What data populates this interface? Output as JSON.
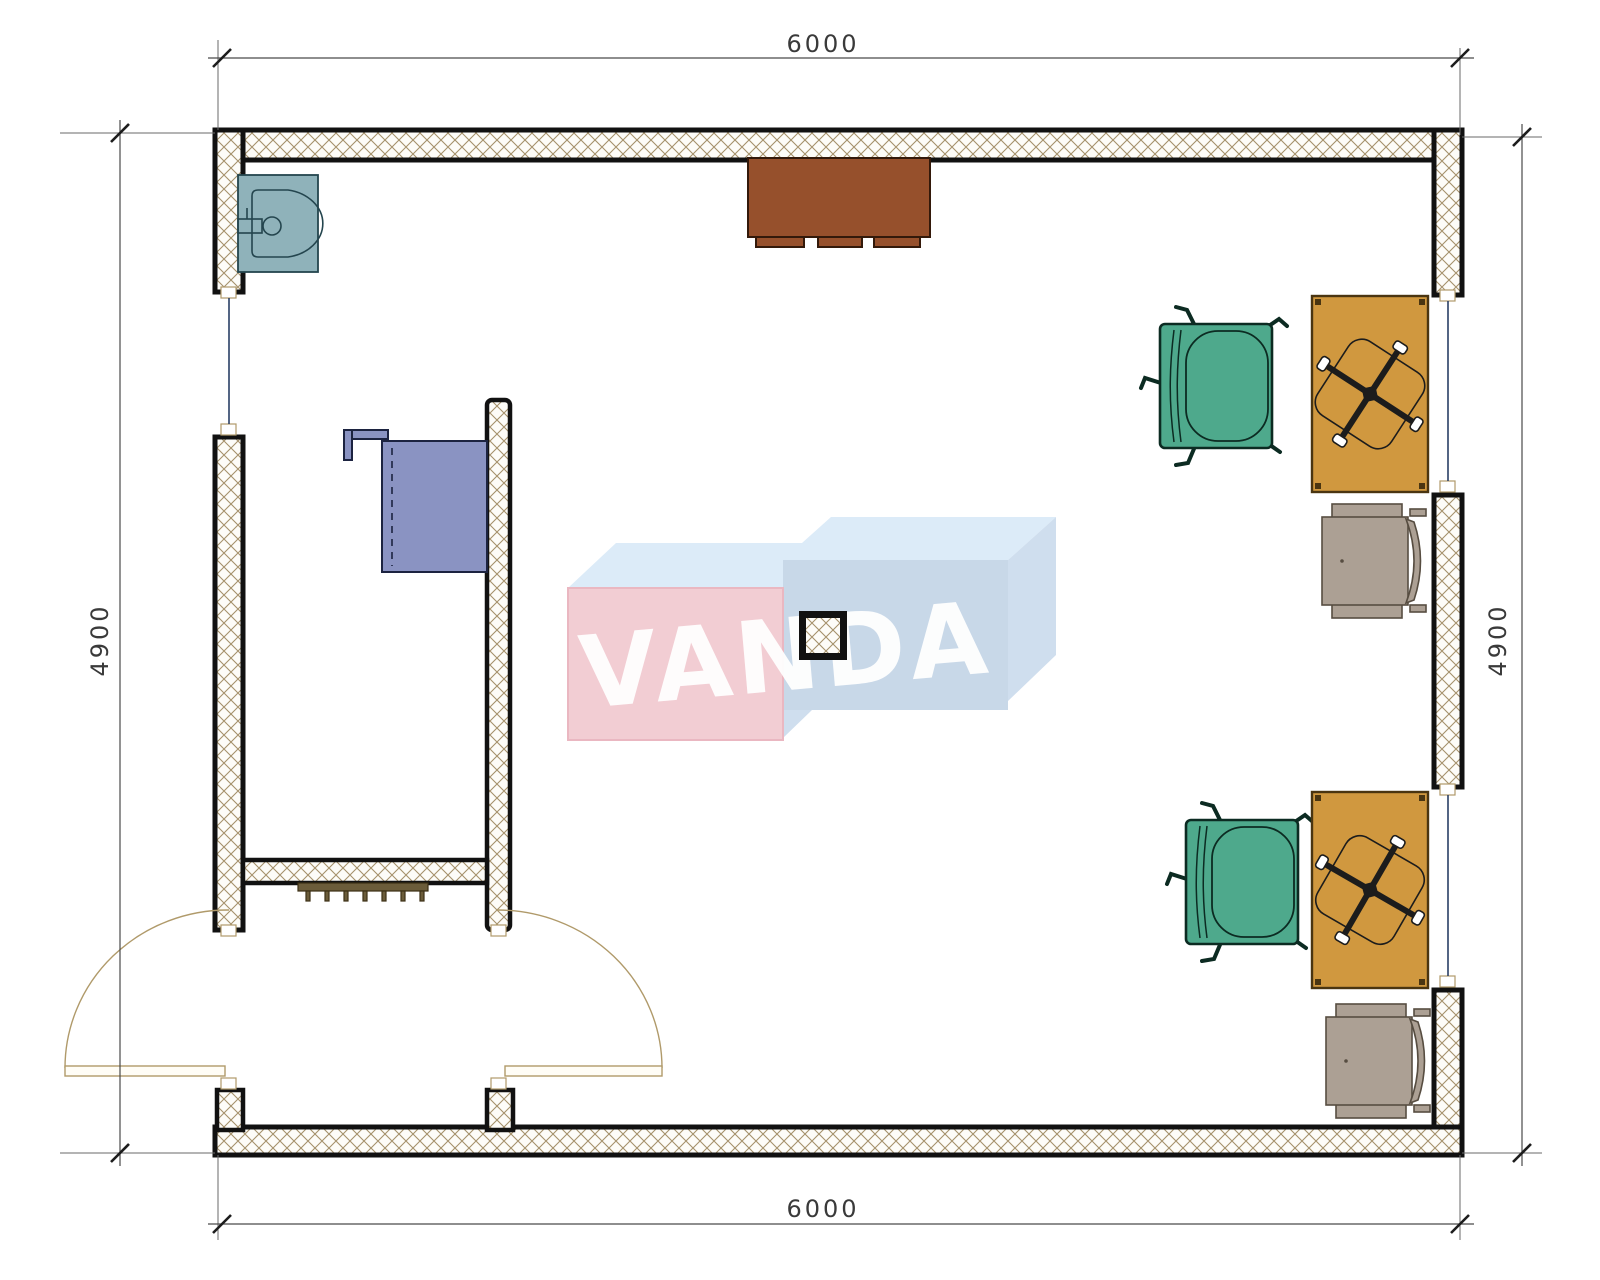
{
  "drawing": {
    "dimensions": {
      "top": "6000",
      "bottom": "6000",
      "left": "4900",
      "right": "4900"
    },
    "watermark": {
      "text": "VANDA"
    },
    "elements": {
      "sink": "sink",
      "top_cabinet": "sideboard-cabinet",
      "blue_cabinet": "wall-cabinet",
      "radiator": "radiator",
      "column": "structural-column",
      "desk": "desk",
      "swivel_chair": "swivel-chair-base",
      "armchair": "green-armchair",
      "guest_chair": "gray-guest-chair",
      "door_left": "entrance-door-left",
      "door_right": "entrance-door-right",
      "window": "window"
    }
  },
  "colors": {
    "wall-hatch": "#a5916b",
    "chair-green": "#4ea98c",
    "chair-green-dark": "#0c2b22",
    "desk": "#d0983f",
    "desk-dark": "#4a3511",
    "chair-gray": "#aca094",
    "chair-gray-dark": "#574d41",
    "cabinet-brown": "#96502c",
    "cabinet-brown-dark": "#33190a",
    "cabinet-blue": "#8a93c2",
    "cabinet-blue-dark": "#1c2340",
    "sink": "#8fb2ba",
    "sink-dark": "#24454e",
    "radiator": "#6b5c3a",
    "window-glass": "#2a3f66",
    "dim-line": "#4a4a4a",
    "dim-text": "#3a3a3a",
    "door-arc": "#b09a6a",
    "wm-pink": "#f2cdd3",
    "wm-pink-edge": "#eab7c1",
    "wm-blue-front": "#c8d8e8",
    "wm-blue-top": "#dcebf8",
    "wm-blue-side": "#cfdeee",
    "wm-text": "#ffffff"
  }
}
